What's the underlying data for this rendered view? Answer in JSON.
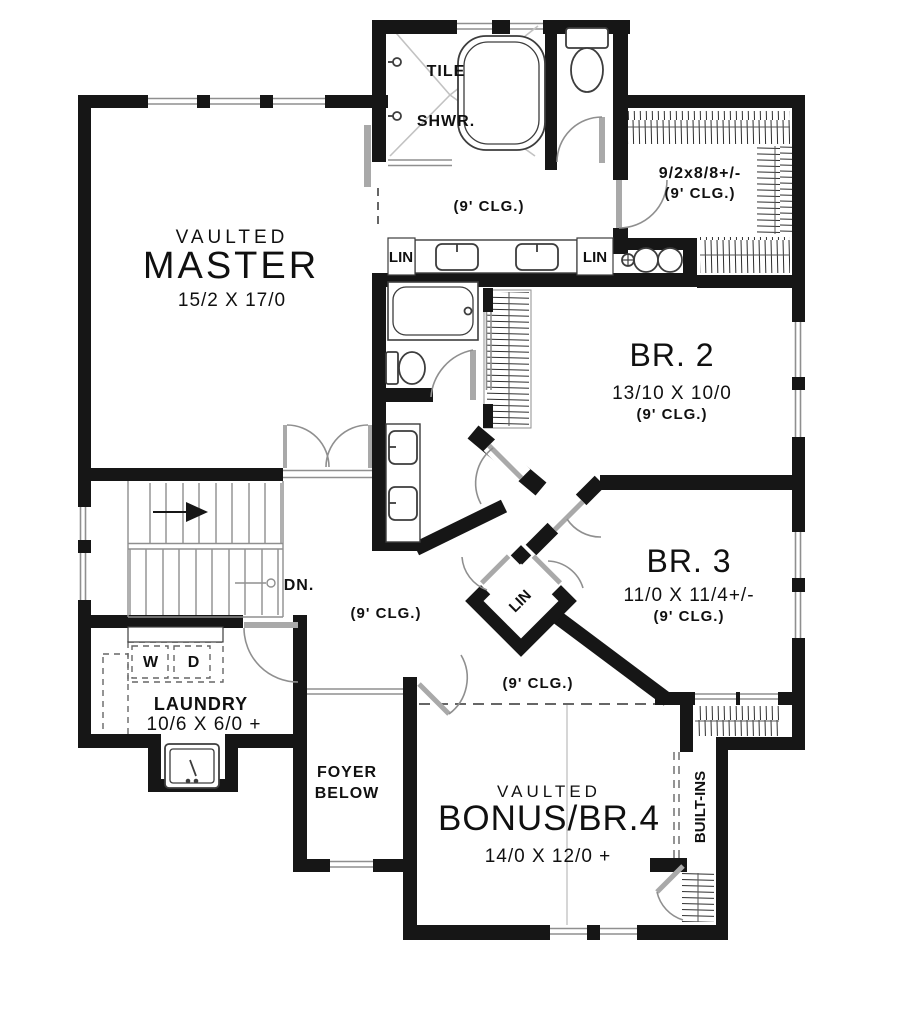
{
  "plan": {
    "rooms": {
      "master": {
        "tag": "VAULTED",
        "name": "MASTER",
        "dims": "15/2 X 17/0"
      },
      "master_bath": {
        "tile": "TILE",
        "shwr": "SHWR.",
        "clg": "(9' CLG.)",
        "lin_left": "LIN",
        "lin_right": "LIN"
      },
      "walkin_closet": {
        "dims": "9/2x8/8+/-",
        "clg": "(9' CLG.)"
      },
      "br2": {
        "name": "BR. 2",
        "dims": "13/10 X 10/0",
        "clg": "(9' CLG.)"
      },
      "br3": {
        "name": "BR. 3",
        "dims": "11/0 X 11/4+/-",
        "clg": "(9' CLG.)"
      },
      "hall": {
        "clg": "(9' CLG.)",
        "dn": "DN.",
        "lin": "LIN"
      },
      "laundry": {
        "name": "LAUNDRY",
        "dims": "10/6 X 6/0 +",
        "washer": "W",
        "dryer": "D"
      },
      "foyer": {
        "line1": "FOYER",
        "line2": "BELOW"
      },
      "bonus": {
        "tag": "VAULTED",
        "name": "BONUS/BR.4",
        "dims": "14/0 X 12/0 +",
        "clg": "(9' CLG.)",
        "builtins": "BUILT-INS"
      }
    },
    "colors": {
      "wall": "#161616",
      "fixture": "#3d3d3d",
      "thin": "#8f8f8f",
      "background": "#ffffff"
    }
  }
}
